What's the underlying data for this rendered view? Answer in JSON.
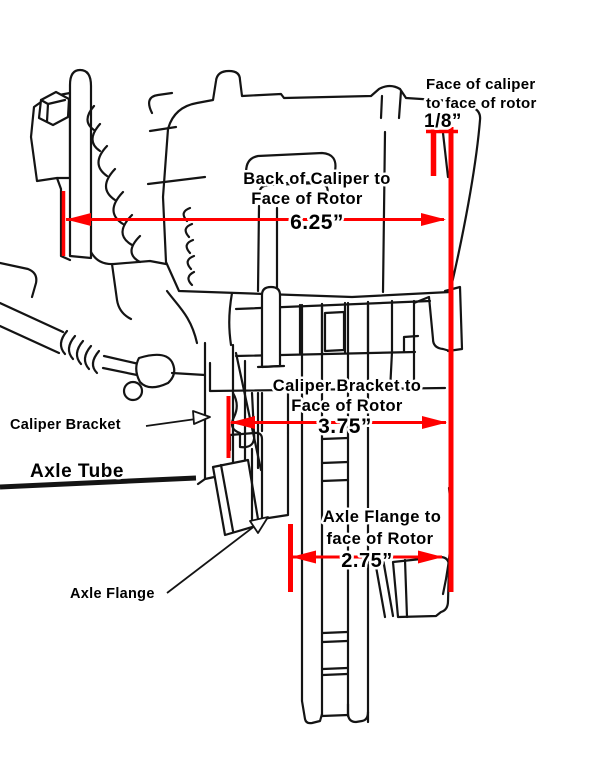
{
  "diagram": {
    "dimensions": {
      "face_of_caliper": {
        "line1": "Face of caliper",
        "line2": "to face of rotor",
        "value": "1/8”"
      },
      "back_of_caliper": {
        "line1": "Back of Caliper to",
        "line2": "Face of Rotor",
        "value": "6.25”"
      },
      "caliper_bracket": {
        "line1": "Caliper Bracket to",
        "line2": "Face of Rotor",
        "value": "3.75”"
      },
      "axle_flange": {
        "line1": "Axle Flange to",
        "line2": "face of Rotor",
        "value": "2.75”"
      }
    },
    "part_labels": {
      "caliper_bracket": "Caliper Bracket",
      "axle_tube": "Axle Tube",
      "axle_flange": "Axle Flange"
    },
    "colors": {
      "dimension_lines": "#ff0000",
      "line_art": "#141414",
      "background": "#ffffff"
    }
  }
}
